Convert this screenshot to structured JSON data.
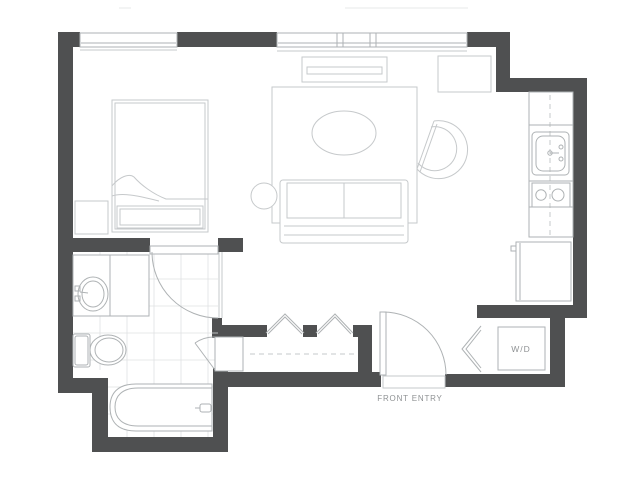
{
  "labels": {
    "washer_dryer": "W/D",
    "front_entry": "FRONT ENTRY"
  },
  "colors": {
    "wall": "#4f5051",
    "line": "#aeb2b4",
    "soft": "#c6c9cb",
    "tile": "#e0e2e3",
    "text": "#8f9294",
    "background": "#ffffff"
  },
  "plan": {
    "type": "studio-apartment-floor-plan",
    "rooms": [
      {
        "name": "bedroom",
        "items": [
          "bed",
          "nightstand",
          "window"
        ]
      },
      {
        "name": "living-room",
        "items": [
          "rug",
          "coffee-table",
          "sofa",
          "side-table",
          "lounge-chair",
          "tv-console",
          "cabinet",
          "window"
        ]
      },
      {
        "name": "kitchen",
        "items": [
          "counter",
          "sink",
          "stove",
          "refrigerator"
        ]
      },
      {
        "name": "bathroom",
        "items": [
          "vanity",
          "sink",
          "toilet",
          "bathtub",
          "tile-floor",
          "door"
        ]
      },
      {
        "name": "closet",
        "items": [
          "bifold-doors",
          "hanging-rod",
          "linen-closet"
        ]
      },
      {
        "name": "entry",
        "items": [
          "front-door",
          "washer-dryer",
          "bifold-door"
        ]
      }
    ]
  }
}
